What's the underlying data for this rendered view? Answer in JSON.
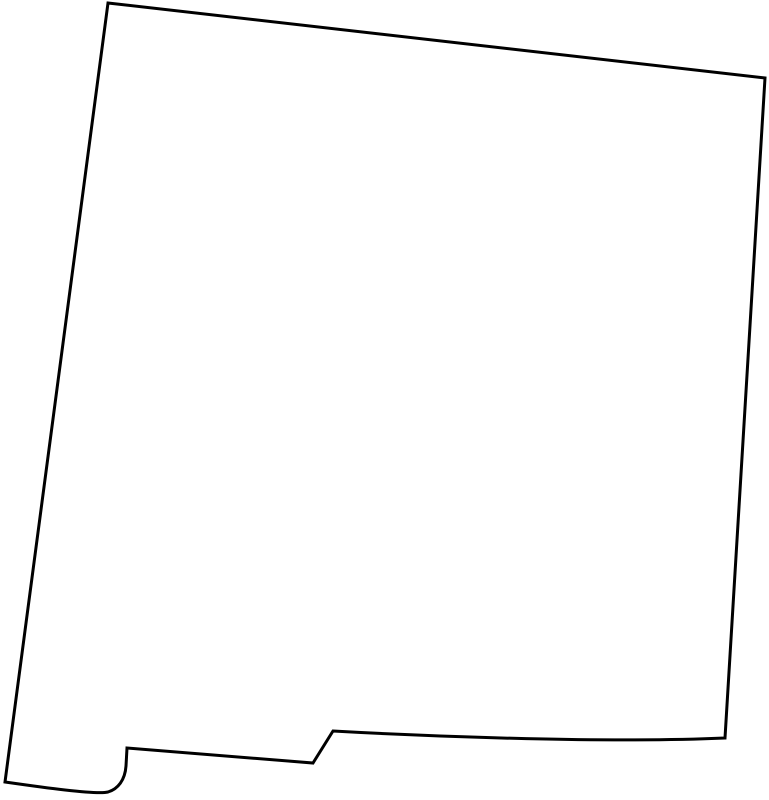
{
  "map": {
    "region_name": "New Mexico",
    "description": "Blank outline map of the U.S. state of New Mexico, black border on white background, no labels or text",
    "outline_path": "M 108 3 L 765 78 L 725 738 C 610 743 440 737 333 731 L 313 763 L 127 748 L 126 766 C 125 780 118 789 108 792 C 96 795 40 787 5 782 Z",
    "stroke_color": "#000000",
    "fill_color": "#ffffff",
    "background_color": "#ffffff",
    "stroke_width": "3",
    "viewbox": "0 0 769 800"
  }
}
